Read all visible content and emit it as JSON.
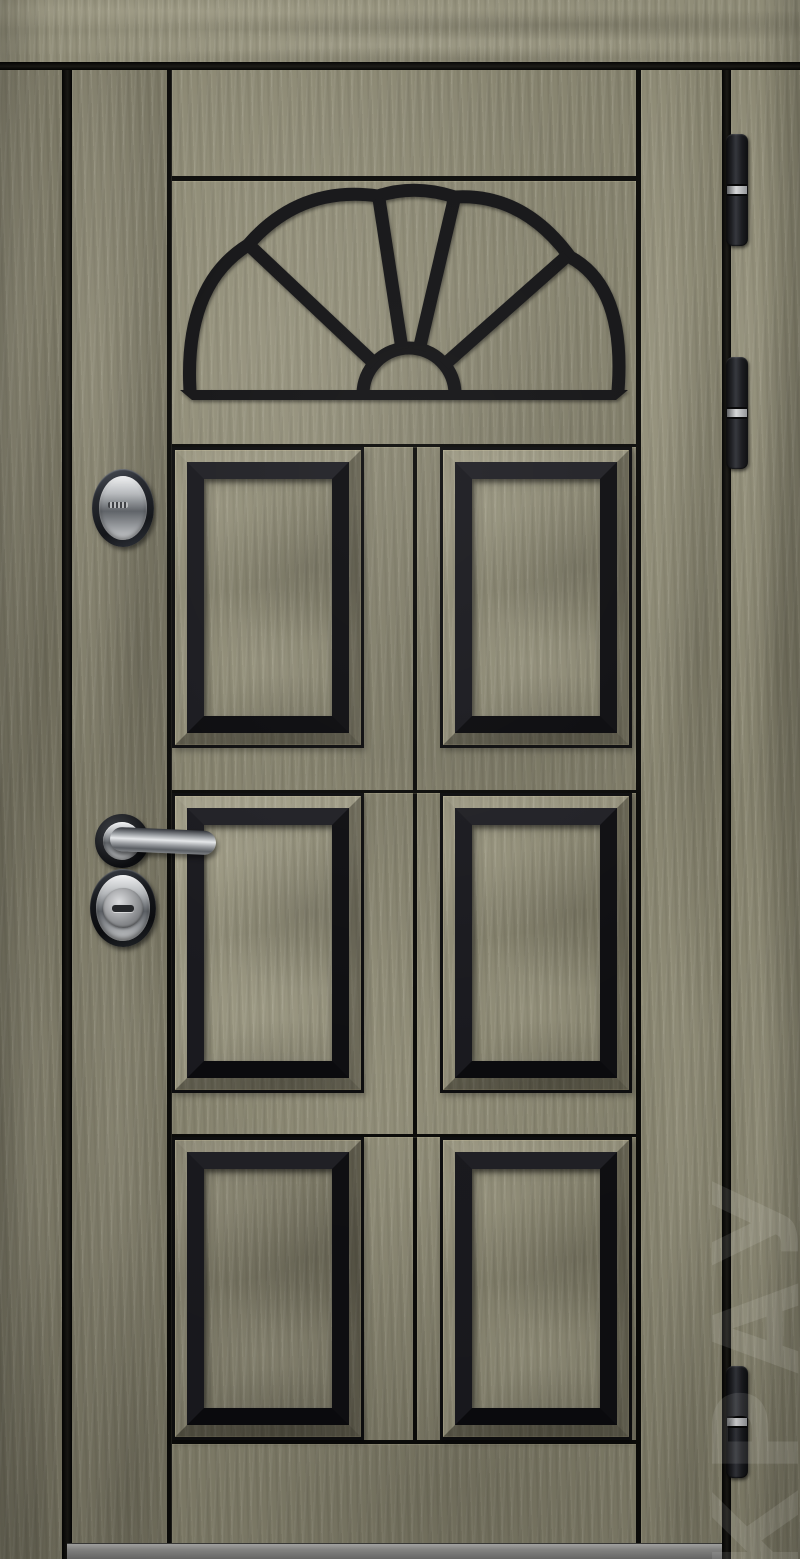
{
  "watermark": {
    "text": "КРАУ",
    "color": "#ffffff"
  },
  "photo": {
    "subject": "entry-door-front-view",
    "setting": "door installed in wood-clad frame over gray threshold"
  },
  "door": {
    "panel_count": 6,
    "panel_rows": 3,
    "panel_columns": 2,
    "fanlight_segments": 5,
    "hinge_count": 3,
    "colors": {
      "wood_base": "#86836e",
      "wood_highlight": "#d8d2b4",
      "wood_shadow": "#55523f",
      "black_trim": "#141416",
      "gap_shadow": "#070706",
      "threshold_gray": "#8e8e8c",
      "chrome": "#c9cbcd",
      "hinge_black": "#1c1d21",
      "hinge_band_silver": "#cfd0d1"
    },
    "hardware": [
      {
        "name": "upper-lock-escutcheon",
        "finish": "black oval with chrome core"
      },
      {
        "name": "lever-handle",
        "finish": "chrome",
        "orientation": "pointing-right"
      },
      {
        "name": "main-lock-cylinder",
        "finish": "black oval with chrome keyhole"
      }
    ]
  }
}
